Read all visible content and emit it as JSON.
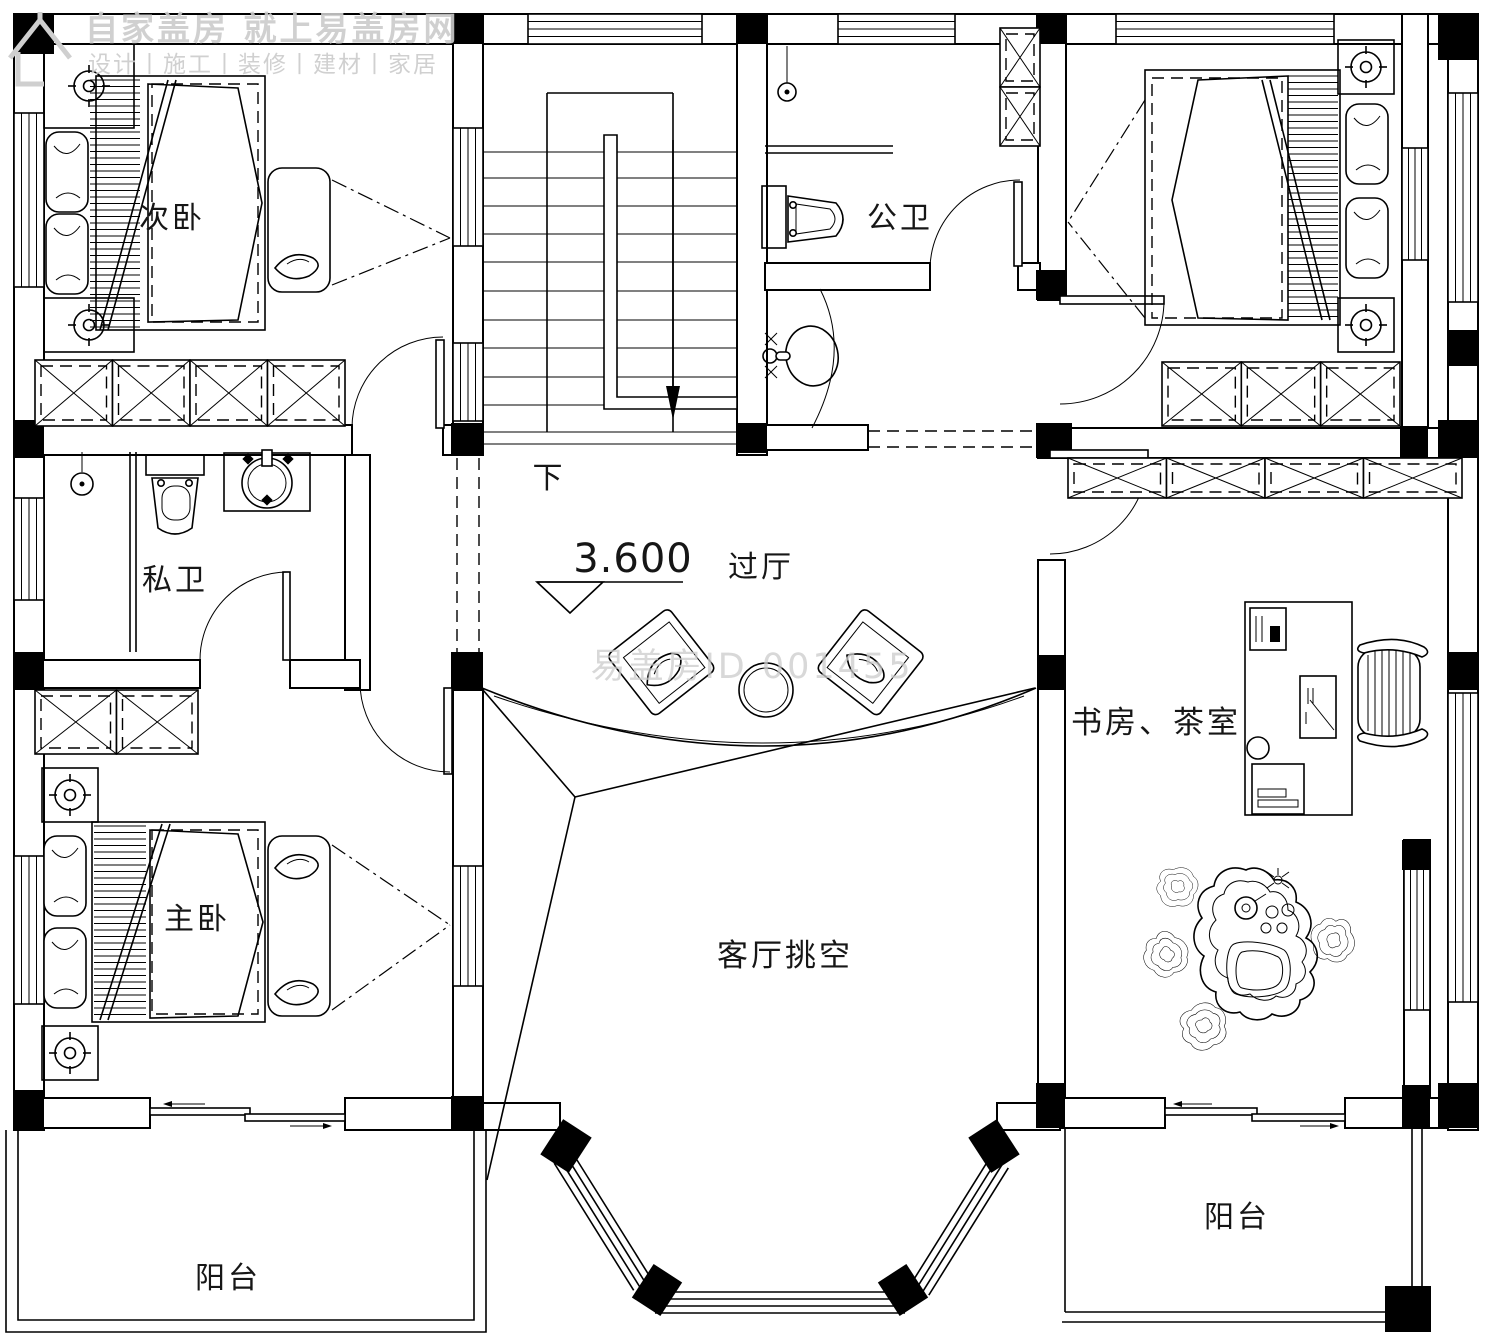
{
  "watermark": {
    "line1": "自家盖房 就上易盖房网",
    "line2": "设计丨施工丨装修丨建材丨家居",
    "center_id": "易盖房ID 001455"
  },
  "elevation": {
    "value": "3.600"
  },
  "stairs": {
    "direction": "下"
  },
  "rooms": {
    "secondary_bedroom": "次卧",
    "public_bath": "公卫",
    "private_bath": "私卫",
    "master_bedroom": "主卧",
    "study_tea_room": "书房、茶室",
    "hallway": "过厅",
    "living_void": "客厅挑空",
    "balcony_left": "阳台",
    "balcony_right": "阳台"
  },
  "colors": {
    "line": "#000000",
    "background": "#ffffff",
    "watermark": "#c9c9c9"
  }
}
